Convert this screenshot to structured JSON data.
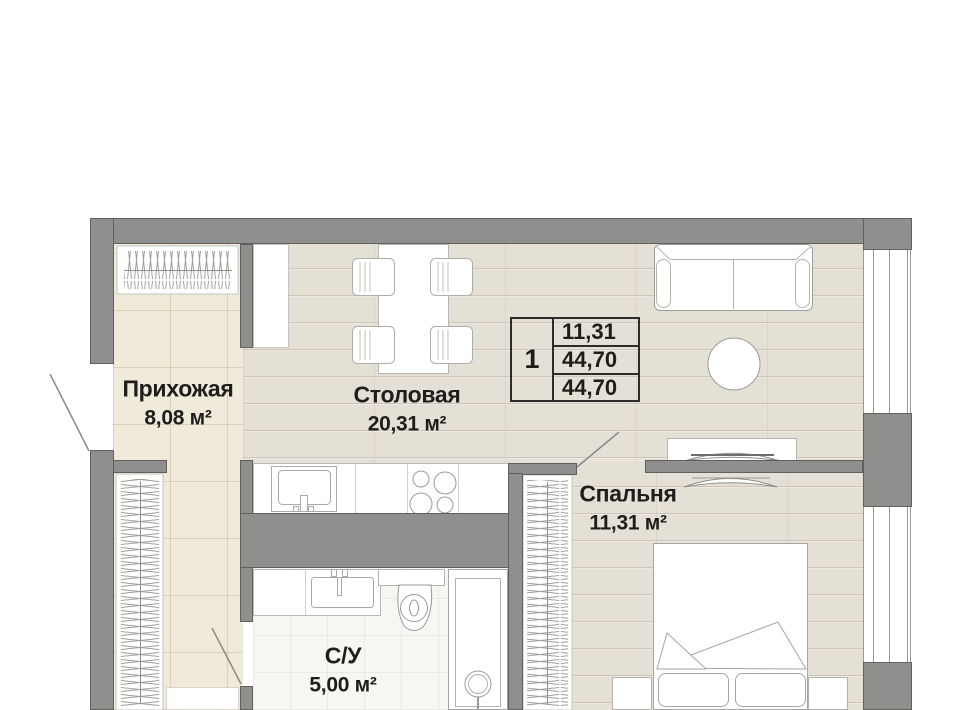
{
  "rooms": {
    "hallway": {
      "name": "Прихожая",
      "area": "8,08 м²"
    },
    "dining": {
      "name": "Столовая",
      "area": "20,31 м²"
    },
    "bedroom": {
      "name": "Спальня",
      "area": "11,31 м²"
    },
    "bathroom": {
      "name": "С/У",
      "area": "5,00 м²"
    }
  },
  "info_table": {
    "rooms_count": "1",
    "rows": [
      "11,31",
      "44,70",
      "44,70"
    ]
  },
  "colors": {
    "wall": "#8f8f8d",
    "wood_floor": "#e5e0d6",
    "tile_floor": "#efead9",
    "bath_floor": "#f7f6f2",
    "text": "#1d1d1b"
  }
}
